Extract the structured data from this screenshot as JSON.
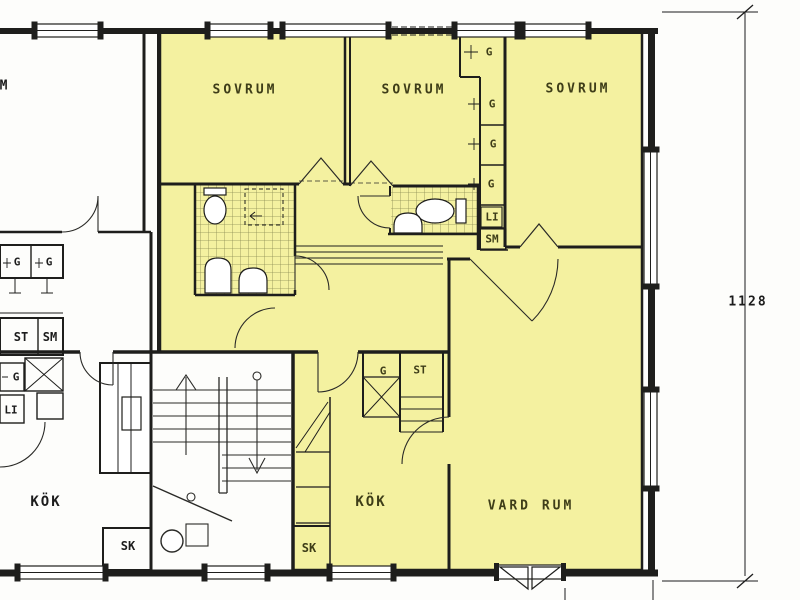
{
  "colors": {
    "highlight_yellow": "#F4F1A0",
    "wall_black": "#1E1E1C",
    "tile_line": "#8B8B52",
    "label_on_yellow": "#3E3D18",
    "label_on_white": "#1C1C1C"
  },
  "apartment": {
    "bedroom1_label": "SOVRUM",
    "bedroom2_label": "SOVRUM",
    "bedroom3_label": "SOVRUM",
    "kitchen_label": "KÖK",
    "living_room_label": "VARD RUM",
    "cleaning_closet_label": "SK",
    "hall_wardrobe_label": "G",
    "hall_storage_label": "ST",
    "wardrobe_top_label": "G",
    "wardrobe1_label": "G",
    "wardrobe2_label": "G",
    "wardrobe3_label": "G",
    "linen_closet_label": "LI",
    "laundry_cupboard_label": "SM"
  },
  "neighbor_apartment": {
    "room_label_partial": "M",
    "wardrobe1_label": "G",
    "wardrobe2_label": "G",
    "storage_label": "ST",
    "laundry_cupboard_label": "SM",
    "wardrobe3_label": "G",
    "linen_closet_label": "LI",
    "kitchen_label": "KÖK",
    "cleaning_closet_label": "SK"
  },
  "dimension": {
    "right_edge_value": "1128"
  }
}
